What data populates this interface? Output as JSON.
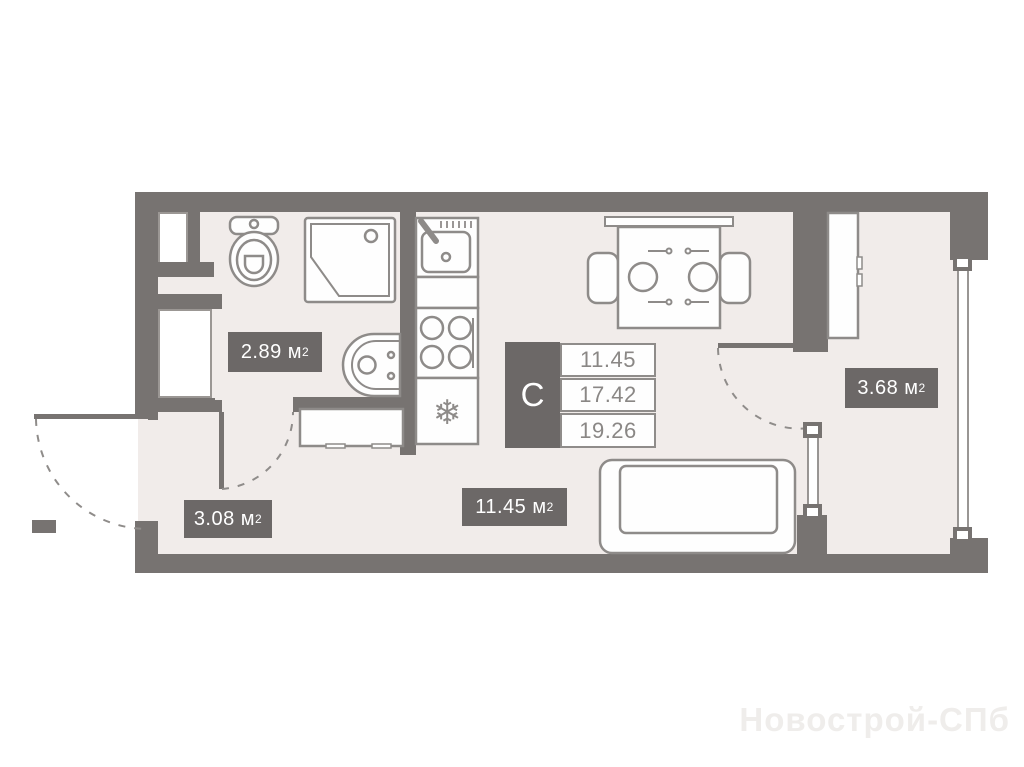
{
  "plan_title": "studio-apartment-floor-plan",
  "info_panel": {
    "type_label": "С",
    "areas": [
      "11.45",
      "17.42",
      "19.26"
    ]
  },
  "room_labels": {
    "bathroom": {
      "value": "2.89",
      "unit": "м",
      "sup": "2"
    },
    "hallway": {
      "value": "3.08",
      "unit": "м",
      "sup": "2"
    },
    "living_room": {
      "value": "11.45",
      "unit": "м",
      "sup": "2"
    },
    "balcony": {
      "value": "3.68",
      "unit": "м",
      "sup": "2"
    }
  },
  "watermark": {
    "text": "Новострой-СПб"
  },
  "colors": {
    "wall": "#777371",
    "label_background": "#6c6867",
    "floor": "#f1ecea",
    "fixture_outline": "#8e8b89",
    "info_text": "#8a8785",
    "watermark_text": "#efedeb"
  }
}
